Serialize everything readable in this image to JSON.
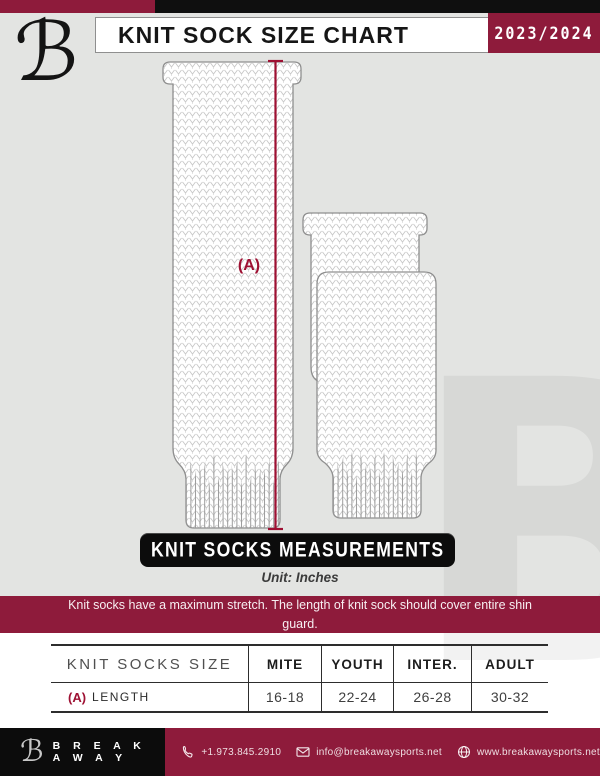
{
  "header": {
    "logo_glyph": "ℬ",
    "title": "KNIT SOCK SIZE CHART",
    "season": "2023/2024"
  },
  "diagram": {
    "measure_label": "(A)",
    "banner": "KNIT SOCKS MEASUREMENTS",
    "unit": "Unit: Inches",
    "note": "Knit socks have a maximum stretch. The length of knit sock should cover entire shin guard."
  },
  "table": {
    "headers": [
      "KNIT SOCKS SIZE",
      "MITE",
      "YOUTH",
      "INTER.",
      "ADULT"
    ],
    "rows": [
      {
        "prefix": "(A)",
        "label": "LENGTH",
        "values": [
          "16-18",
          "22-24",
          "26-28",
          "30-32"
        ]
      }
    ]
  },
  "footer": {
    "logo_glyph": "ℬ",
    "brand": "B R E A K A W A Y",
    "phone": "+1.973.845.2910",
    "email": "info@breakawaysports.net",
    "website": "www.breakawaysports.net"
  },
  "watermark": "B",
  "colors": {
    "maroon": "#8E1B3B",
    "accent": "#9E1133",
    "black": "#0F0F0F",
    "background": "#E3E4E2"
  }
}
